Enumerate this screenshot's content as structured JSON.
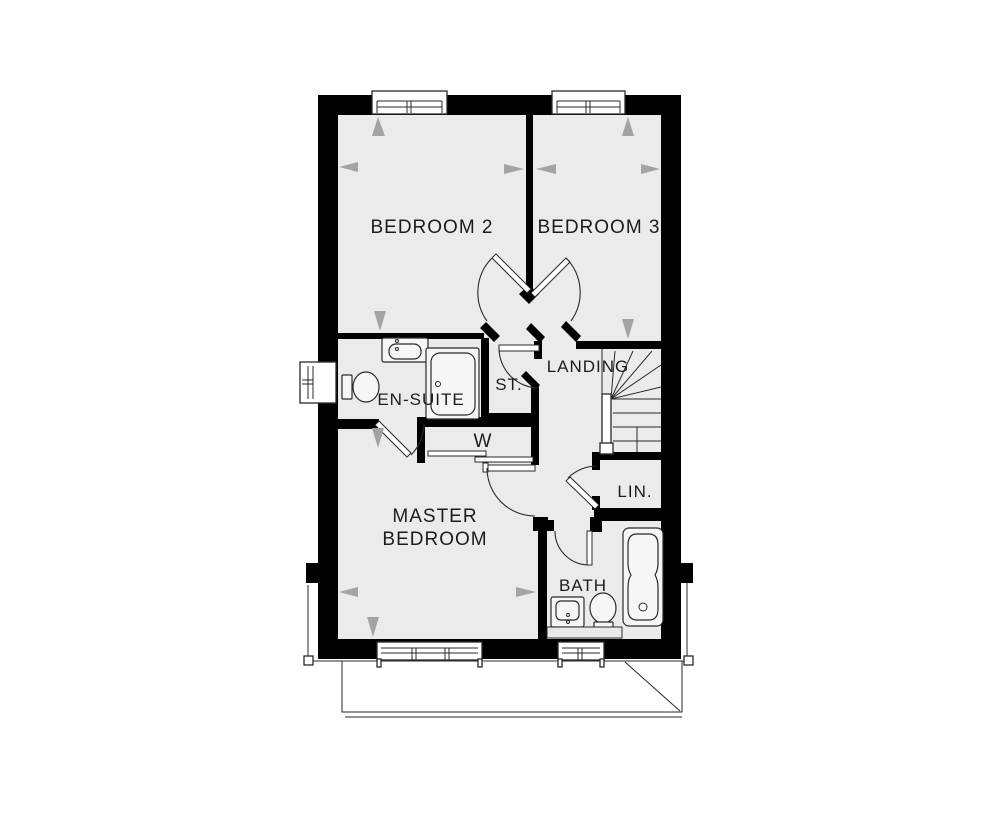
{
  "document": {
    "type": "floor-plan"
  },
  "colors": {
    "wall": "#000000",
    "floor": "#ebebeb",
    "line": "#2a2a2a",
    "label": "#1c1c1c",
    "arrow": "#a3a3a3"
  },
  "rooms": {
    "bedroom2": "BEDROOM 2",
    "bedroom3": "BEDROOM 3",
    "landing": "LANDING",
    "storage": "ST.",
    "ensuite": "EN-SUITE",
    "wardrobe": "W",
    "master_line1": "MASTER",
    "master_line2": "BEDROOM",
    "linen": "LIN.",
    "bath": "BATH"
  }
}
